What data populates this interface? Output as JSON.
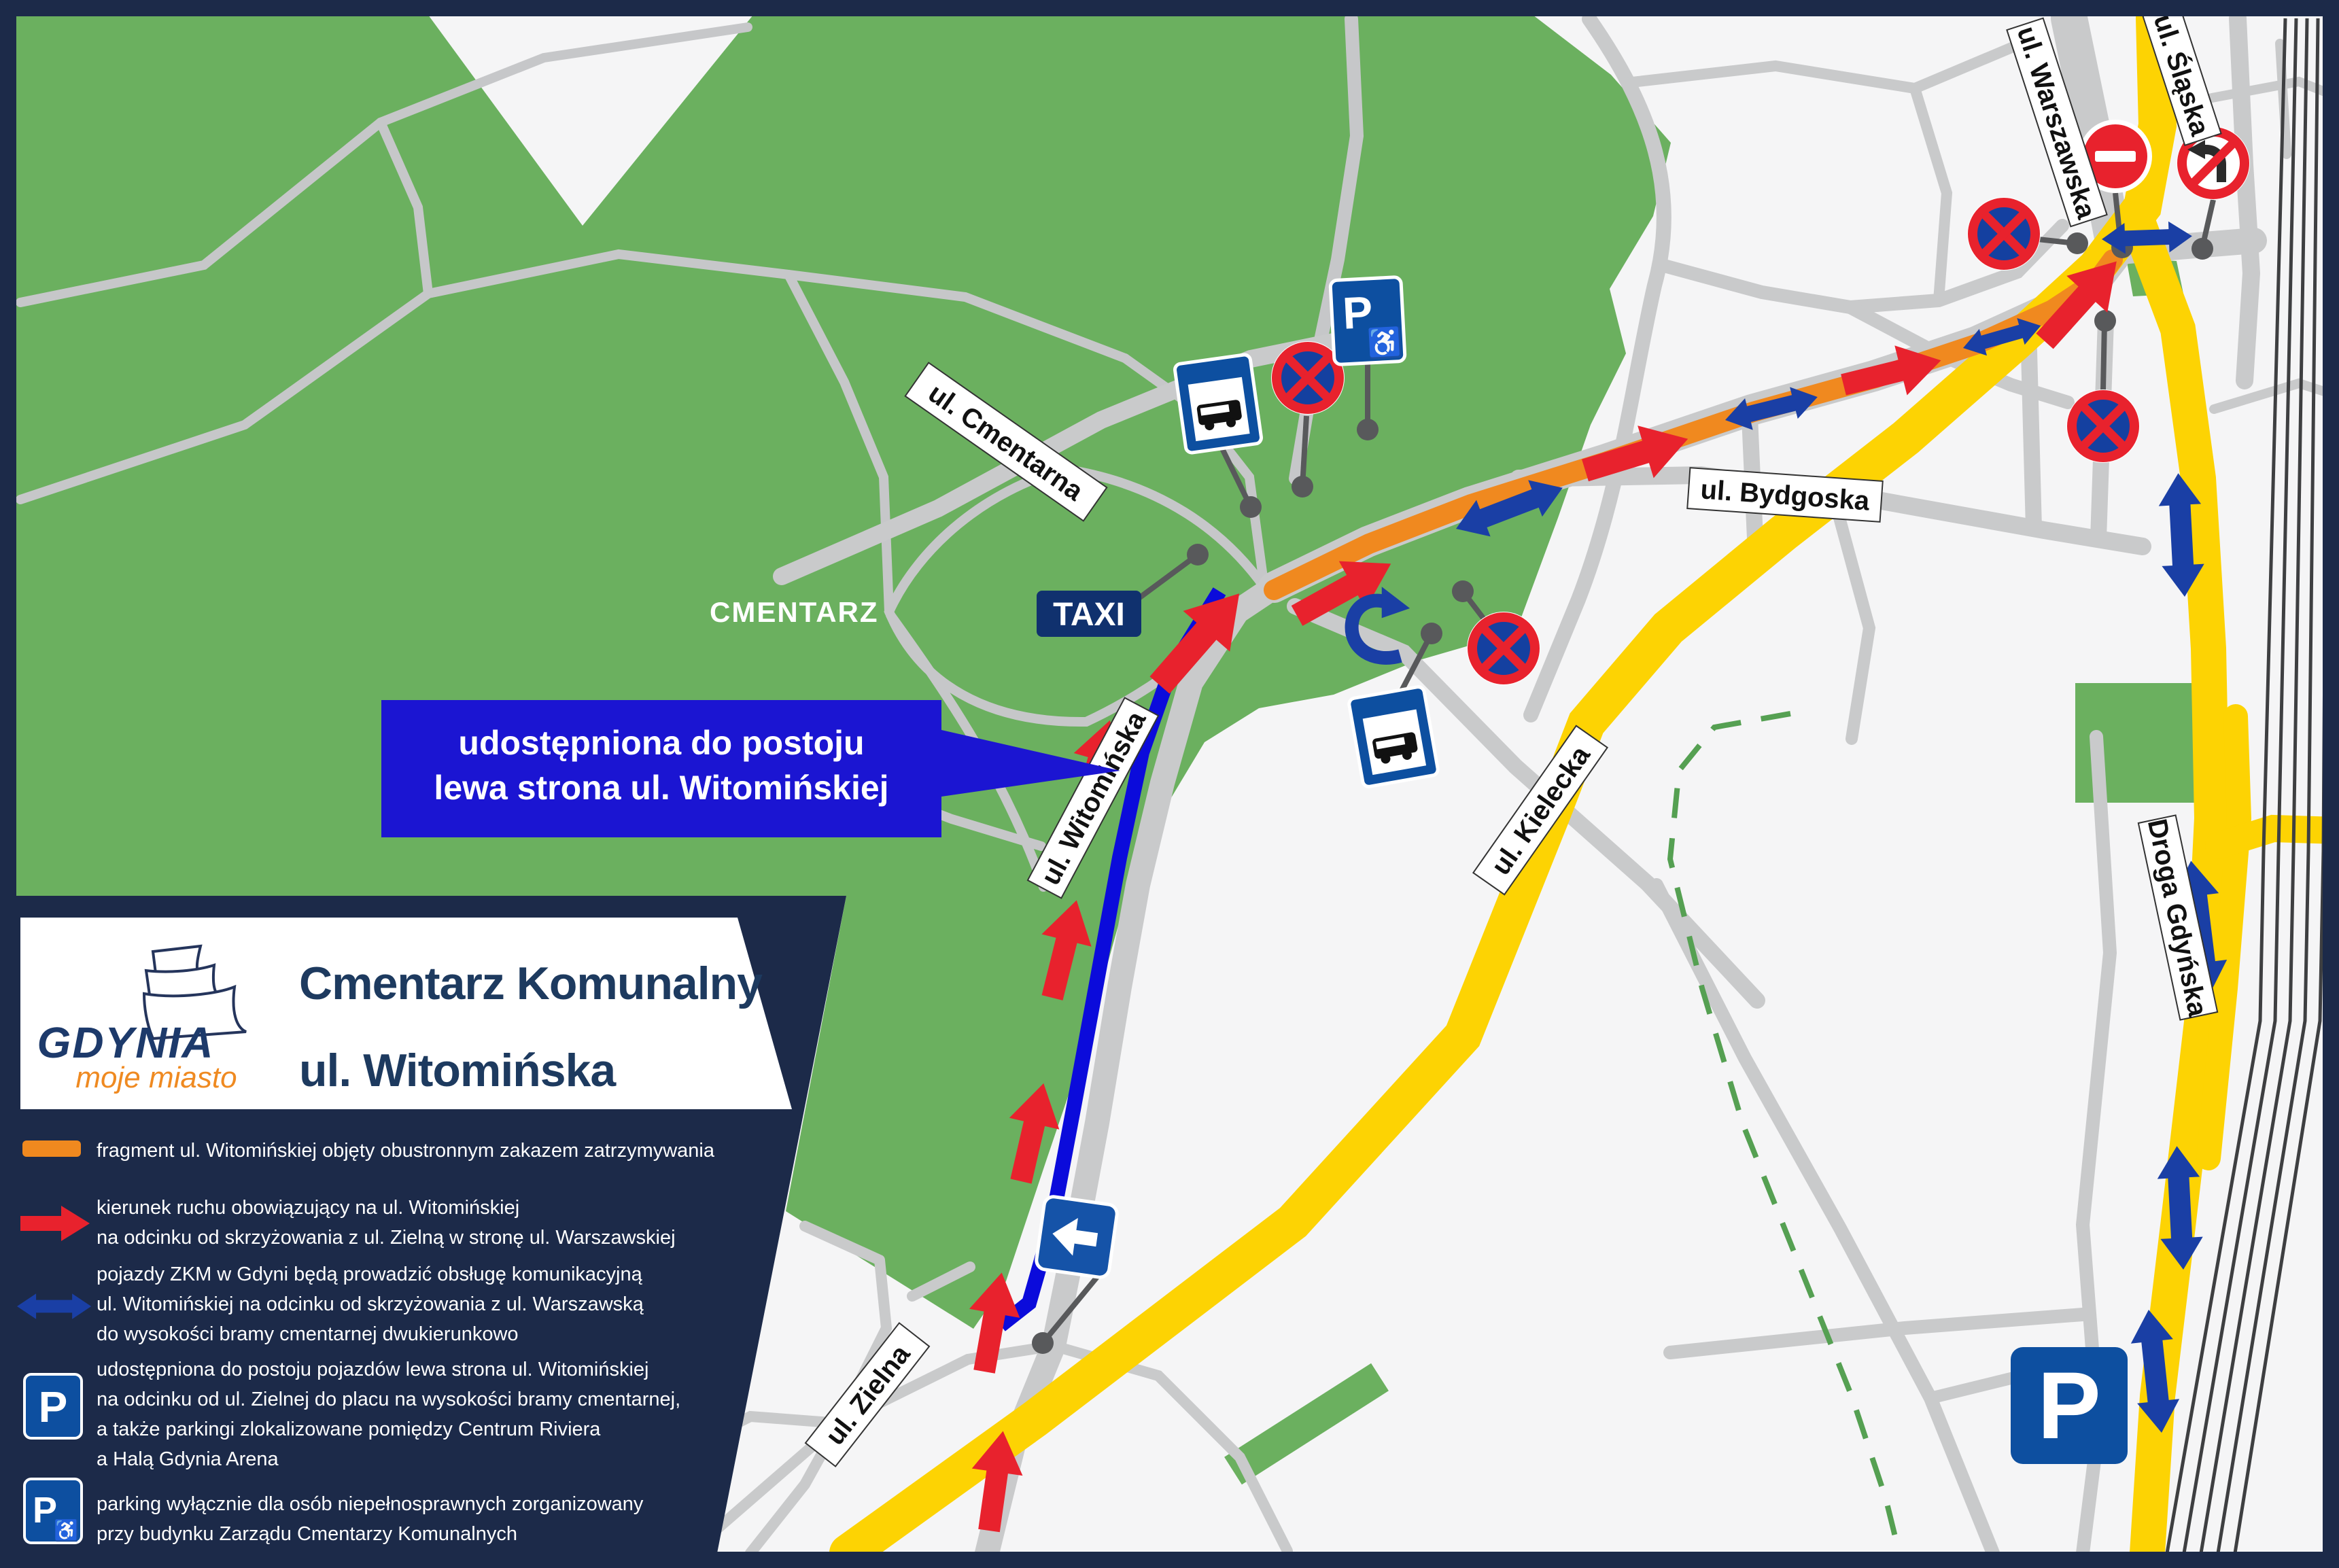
{
  "title": {
    "line1": "Cmentarz Komunalny",
    "line2": "ul. Witomińska"
  },
  "logo": {
    "name": "GDYNIA",
    "tagline": "moje miasto"
  },
  "callout": {
    "line1": "udostępniona do postoju",
    "line2": "lewa strona ul. Witomińskiej"
  },
  "area_labels": {
    "cemetery": "CMENTARZ"
  },
  "street_labels": {
    "cmentarna": "ul. Cmentarna",
    "witominska": "ul. Witomińska",
    "bydgoska": "ul. Bydgoska",
    "kielecka": "ul. Kielecka",
    "zielna": "ul. Zielna",
    "warszawska": "ul. Warszawska",
    "slaska": "ul. Śląska",
    "droga_gdynska": "Droga Gdyńska"
  },
  "signs": {
    "parking_letter": "P",
    "wheelchair_icon": "♿",
    "taxi": "TAXI"
  },
  "legend": {
    "items": [
      {
        "icon": "orange-segment",
        "lines": [
          "fragment ul. Witomińskiej objęty obustronnym zakazem zatrzymywania"
        ]
      },
      {
        "icon": "red-arrow",
        "lines": [
          "kierunek ruchu obowiązujący na ul. Witomińskiej",
          "na odcinku od skrzyżowania z ul. Zielną w stronę ul. Warszawskiej"
        ]
      },
      {
        "icon": "blue-double-arrow",
        "lines": [
          "pojazdy ZKM w Gdyni będą prowadzić obsługę komunikacyjną",
          "ul. Witomińskiej na odcinku od skrzyżowania z ul. Warszawską",
          "do wysokości bramy cmentarnej dwukierunkowo"
        ]
      },
      {
        "icon": "parking-sign",
        "lines": [
          "udostępniona do postoju pojazdów lewa strona ul. Witomińskiej",
          "na odcinku od ul. Zielnej do placu na wysokości bramy cmentarnej,",
          "a także parkingi zlokalizowane pomiędzy Centrum Riviera",
          "a Halą Gdynia Arena"
        ]
      },
      {
        "icon": "disabled-parking-sign",
        "lines": [
          "parking wyłącznie dla osób niepełnosprawnych zorganizowany",
          "przy budynku Zarządu Cmentarzy Komunalnych"
        ]
      }
    ]
  },
  "colors": {
    "panel_navy": "#1c2a49",
    "map_green": "#6bb05f",
    "road_yellow": "#fdd303",
    "route_orange": "#f0891f",
    "arrow_red": "#e8222d",
    "arrow_blue": "#1a3fa5",
    "callout_blue": "#1b15d2",
    "parking_line_blue": "#0b0bdb",
    "sign_blue": "#0d4fa0",
    "road_gray": "#c9cacb"
  }
}
